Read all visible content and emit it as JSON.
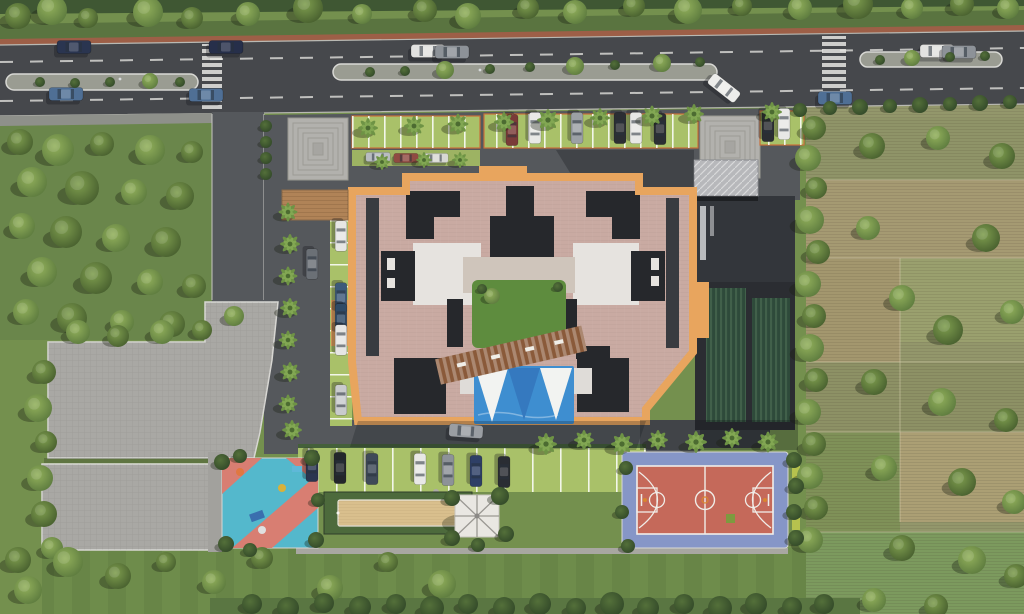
{
  "meta": {
    "title": "Aerial 3D master-plan render of a residential apartment complex",
    "view": "top-down site plan",
    "visible_text": "none"
  },
  "palette": {
    "grass": "#74904e",
    "grassWood": "#6a864b",
    "field": "#93976b",
    "road": "#46484c",
    "asphalt": "#55585c",
    "paver": "#a9a8a4",
    "paverLight": "#b2b1ad",
    "curb": "#cfcfcb",
    "cycle": "#9d5f47",
    "hedge": "#4c6639",
    "roofPink": "#c9aaa2",
    "roofOrange": "#e8a55e",
    "roofDark": "#26282c",
    "roofWhite": "#e6e3df",
    "deck": "#cfc5bb",
    "lawn": "#5e8c3e",
    "pool": "#3e8ed0",
    "sailWhite": "#f2f3f1",
    "sailBlue": "#3579bf",
    "courtOuter": "#8696c7",
    "courtInner": "#c5695a",
    "courtLine": "#f0ede8",
    "pgBlue": "#54b8cc",
    "pgPink": "#d87e72",
    "sand": "#d9bf8d",
    "stall": "#a9c169",
    "wood": "#8a5a3a",
    "woodDeck": "#b08357",
    "gazebo": "#e9e7e2",
    "laneDash": "#d6d6d2",
    "wing": "#2b2d32"
  },
  "site_elements": {
    "main_road": "dual carriageway with planted medians, cycle track, two zebra crossings",
    "building": "courtyard apartment block, terracotta parapet band, dark cores, central garden, pergola and swimming pool with shade sails",
    "amenities": [
      "basketball court",
      "kids playground",
      "sand court",
      "gazebo",
      "pool with tensile sails",
      "lawns"
    ],
    "parking": "perpendicular grass-paver stalls on north, west and south sides plus large paver podium",
    "surroundings": "woodland grove west, farmland plots east, tree-lined boundary hedges"
  },
  "vegetation": {
    "trees": [
      [
        18,
        16,
        13,
        "d"
      ],
      [
        52,
        10,
        15,
        "l"
      ],
      [
        88,
        18,
        10,
        "d"
      ],
      [
        148,
        12,
        15,
        "l"
      ],
      [
        192,
        18,
        11,
        "d"
      ],
      [
        248,
        14,
        12,
        "l"
      ],
      [
        308,
        8,
        15,
        "d"
      ],
      [
        362,
        14,
        10,
        "l"
      ],
      [
        425,
        10,
        12,
        "d"
      ],
      [
        468,
        16,
        13,
        "l"
      ],
      [
        528,
        8,
        11,
        "d"
      ],
      [
        575,
        12,
        12,
        "l"
      ],
      [
        634,
        6,
        11,
        "d"
      ],
      [
        688,
        10,
        14,
        "l"
      ],
      [
        742,
        6,
        10,
        "d"
      ],
      [
        800,
        8,
        12,
        "l"
      ],
      [
        858,
        4,
        15,
        "d"
      ],
      [
        912,
        8,
        11,
        "l"
      ],
      [
        962,
        4,
        12,
        "d"
      ],
      [
        1008,
        8,
        11,
        "l"
      ],
      [
        20,
        142,
        13,
        "d"
      ],
      [
        58,
        150,
        16,
        "l"
      ],
      [
        102,
        144,
        12,
        "d"
      ],
      [
        150,
        150,
        15,
        "l"
      ],
      [
        192,
        152,
        11,
        "d"
      ],
      [
        32,
        182,
        15,
        "l"
      ],
      [
        82,
        188,
        17,
        "d"
      ],
      [
        134,
        192,
        13,
        "l"
      ],
      [
        180,
        196,
        14,
        "d"
      ],
      [
        22,
        226,
        13,
        "l"
      ],
      [
        66,
        232,
        16,
        "d"
      ],
      [
        116,
        238,
        14,
        "l"
      ],
      [
        166,
        242,
        15,
        "d"
      ],
      [
        42,
        272,
        15,
        "l"
      ],
      [
        96,
        278,
        16,
        "d"
      ],
      [
        150,
        282,
        13,
        "l"
      ],
      [
        194,
        286,
        12,
        "d"
      ],
      [
        26,
        312,
        13,
        "l"
      ],
      [
        72,
        318,
        15,
        "d"
      ],
      [
        122,
        322,
        12,
        "l"
      ],
      [
        172,
        324,
        13,
        "d"
      ],
      [
        78,
        332,
        12,
        "l"
      ],
      [
        118,
        336,
        11,
        "d"
      ],
      [
        162,
        332,
        12,
        "l"
      ],
      [
        202,
        330,
        10,
        "d"
      ],
      [
        234,
        316,
        10,
        "l"
      ],
      [
        44,
        372,
        12,
        "d"
      ],
      [
        38,
        408,
        14,
        "l"
      ],
      [
        46,
        442,
        11,
        "d"
      ],
      [
        40,
        478,
        13,
        "l"
      ],
      [
        44,
        514,
        13,
        "d"
      ],
      [
        52,
        548,
        11,
        "l"
      ],
      [
        18,
        560,
        13,
        "d"
      ],
      [
        68,
        562,
        15,
        "l"
      ],
      [
        118,
        576,
        13,
        "d"
      ],
      [
        28,
        590,
        14,
        "l"
      ],
      [
        166,
        562,
        10,
        "d"
      ],
      [
        214,
        582,
        12,
        "l"
      ],
      [
        262,
        558,
        11,
        "d"
      ],
      [
        330,
        588,
        13,
        "l"
      ],
      [
        388,
        562,
        10,
        "d"
      ],
      [
        442,
        584,
        14,
        "l"
      ],
      [
        814,
        128,
        12,
        "d"
      ],
      [
        808,
        158,
        13,
        "l"
      ],
      [
        816,
        188,
        11,
        "d"
      ],
      [
        810,
        220,
        14,
        "l"
      ],
      [
        818,
        252,
        12,
        "d"
      ],
      [
        808,
        284,
        13,
        "l"
      ],
      [
        814,
        316,
        12,
        "d"
      ],
      [
        810,
        348,
        14,
        "l"
      ],
      [
        816,
        380,
        12,
        "d"
      ],
      [
        808,
        412,
        13,
        "l"
      ],
      [
        814,
        444,
        12,
        "d"
      ],
      [
        810,
        476,
        13,
        "l"
      ],
      [
        816,
        508,
        12,
        "d"
      ],
      [
        810,
        540,
        13,
        "l"
      ],
      [
        872,
        146,
        13,
        "d"
      ],
      [
        938,
        138,
        12,
        "l"
      ],
      [
        1002,
        156,
        13,
        "d"
      ],
      [
        868,
        228,
        12,
        "l"
      ],
      [
        986,
        238,
        14,
        "d"
      ],
      [
        902,
        298,
        13,
        "l"
      ],
      [
        948,
        330,
        15,
        "d"
      ],
      [
        1012,
        312,
        12,
        "l"
      ],
      [
        874,
        382,
        13,
        "d"
      ],
      [
        942,
        402,
        14,
        "l"
      ],
      [
        1006,
        420,
        12,
        "d"
      ],
      [
        884,
        468,
        13,
        "l"
      ],
      [
        962,
        482,
        14,
        "d"
      ],
      [
        1014,
        502,
        12,
        "l"
      ],
      [
        902,
        548,
        13,
        "d"
      ],
      [
        972,
        560,
        14,
        "l"
      ],
      [
        1016,
        576,
        12,
        "d"
      ],
      [
        874,
        600,
        12,
        "l"
      ],
      [
        936,
        606,
        12,
        "d"
      ],
      [
        492,
        296,
        8,
        "l"
      ],
      [
        482,
        289,
        5,
        "b"
      ],
      [
        558,
        287,
        5,
        "b"
      ],
      [
        40,
        82,
        5,
        "b"
      ],
      [
        75,
        83,
        5,
        "b"
      ],
      [
        110,
        82,
        5,
        "b"
      ],
      [
        150,
        81,
        8,
        "l"
      ],
      [
        180,
        82,
        5,
        "b"
      ],
      [
        370,
        72,
        5,
        "b"
      ],
      [
        405,
        71,
        5,
        "b"
      ],
      [
        445,
        70,
        9,
        "l"
      ],
      [
        490,
        69,
        5,
        "b"
      ],
      [
        530,
        67,
        5,
        "b"
      ],
      [
        575,
        66,
        9,
        "l"
      ],
      [
        615,
        65,
        5,
        "b"
      ],
      [
        662,
        63,
        9,
        "l"
      ],
      [
        700,
        62,
        5,
        "b"
      ],
      [
        880,
        60,
        5,
        "b"
      ],
      [
        912,
        58,
        8,
        "l"
      ],
      [
        950,
        57,
        5,
        "b"
      ],
      [
        985,
        56,
        5,
        "b"
      ],
      [
        222,
        462,
        8,
        "b"
      ],
      [
        240,
        456,
        7,
        "b"
      ],
      [
        312,
        458,
        8,
        "b"
      ],
      [
        318,
        500,
        7,
        "b"
      ],
      [
        316,
        540,
        8,
        "b"
      ],
      [
        226,
        544,
        8,
        "b"
      ],
      [
        250,
        550,
        7,
        "b"
      ],
      [
        452,
        498,
        8,
        "b"
      ],
      [
        500,
        496,
        9,
        "b"
      ],
      [
        506,
        534,
        8,
        "b"
      ],
      [
        452,
        538,
        8,
        "b"
      ],
      [
        478,
        545,
        7,
        "b"
      ],
      [
        626,
        468,
        7,
        "b"
      ],
      [
        622,
        512,
        7,
        "b"
      ],
      [
        628,
        546,
        7,
        "b"
      ],
      [
        252,
        604,
        10,
        "b"
      ],
      [
        288,
        608,
        11,
        "b"
      ],
      [
        324,
        603,
        10,
        "b"
      ],
      [
        360,
        607,
        11,
        "b"
      ],
      [
        396,
        604,
        10,
        "b"
      ],
      [
        432,
        608,
        12,
        "b"
      ],
      [
        468,
        604,
        10,
        "b"
      ],
      [
        504,
        608,
        11,
        "b"
      ],
      [
        540,
        604,
        11,
        "b"
      ],
      [
        576,
        608,
        10,
        "b"
      ],
      [
        612,
        604,
        12,
        "b"
      ],
      [
        648,
        608,
        11,
        "b"
      ],
      [
        684,
        604,
        10,
        "b"
      ],
      [
        720,
        608,
        12,
        "b"
      ],
      [
        756,
        604,
        11,
        "b"
      ],
      [
        792,
        607,
        10,
        "b"
      ],
      [
        824,
        604,
        10,
        "b"
      ],
      [
        800,
        110,
        7,
        "b"
      ],
      [
        830,
        108,
        7,
        "b"
      ],
      [
        860,
        107,
        8,
        "b"
      ],
      [
        890,
        106,
        7,
        "b"
      ],
      [
        920,
        105,
        8,
        "b"
      ],
      [
        950,
        104,
        7,
        "b"
      ],
      [
        980,
        103,
        8,
        "b"
      ],
      [
        1010,
        102,
        7,
        "b"
      ],
      [
        794,
        460,
        8,
        "b"
      ],
      [
        796,
        486,
        8,
        "b"
      ],
      [
        794,
        512,
        8,
        "b"
      ],
      [
        796,
        538,
        8,
        "b"
      ],
      [
        266,
        126,
        6,
        "b"
      ],
      [
        266,
        142,
        6,
        "b"
      ],
      [
        266,
        158,
        6,
        "b"
      ],
      [
        266,
        174,
        6,
        "b"
      ]
    ],
    "palms": [
      [
        368,
        128,
        1
      ],
      [
        414,
        126,
        1
      ],
      [
        458,
        124,
        1.05
      ],
      [
        504,
        122,
        1
      ],
      [
        548,
        120,
        1.1
      ],
      [
        600,
        118,
        1
      ],
      [
        652,
        116,
        1.05
      ],
      [
        694,
        114,
        1
      ],
      [
        772,
        112,
        1
      ],
      [
        382,
        162,
        0.8
      ],
      [
        424,
        160,
        0.8
      ],
      [
        460,
        160,
        0.8
      ],
      [
        288,
        212,
        0.95
      ],
      [
        290,
        244,
        1
      ],
      [
        288,
        276,
        0.95
      ],
      [
        290,
        308,
        1
      ],
      [
        288,
        340,
        0.95
      ],
      [
        290,
        372,
        1
      ],
      [
        288,
        404,
        0.95
      ],
      [
        292,
        430,
        1
      ],
      [
        546,
        444,
        1.1
      ],
      [
        584,
        440,
        1
      ],
      [
        622,
        444,
        1.1
      ],
      [
        658,
        440,
        1
      ],
      [
        696,
        442,
        1.1
      ],
      [
        732,
        438,
        1
      ],
      [
        768,
        442,
        1.05
      ]
    ]
  },
  "vehicles": {
    "cars": [
      [
        74,
        47,
        0,
        1,
        "#2a3550"
      ],
      [
        66,
        94,
        0,
        1,
        "#4f6f95"
      ],
      [
        226,
        47,
        0,
        1,
        "#262f4a"
      ],
      [
        206,
        95,
        0,
        1,
        "#4f6f95"
      ],
      [
        428,
        51,
        0,
        1,
        "#e2e2e0"
      ],
      [
        452,
        52,
        0,
        1,
        "#8d9298"
      ],
      [
        724,
        88,
        38,
        1,
        "#ededeb"
      ],
      [
        835,
        98,
        0,
        1,
        "#4f6f95"
      ],
      [
        937,
        51,
        0,
        1,
        "#e2e2e0"
      ],
      [
        959,
        52,
        0,
        1,
        "#8d9298"
      ],
      [
        512,
        130,
        90,
        0.92,
        "#7a3b38"
      ],
      [
        535,
        128,
        90,
        0.92,
        "#e8e8e6"
      ],
      [
        577,
        128,
        90,
        0.92,
        "#9ba0a5"
      ],
      [
        620,
        128,
        90,
        0.92,
        "#2b2e33"
      ],
      [
        636,
        128,
        90,
        0.92,
        "#e8e8e6"
      ],
      [
        660,
        129,
        90,
        0.92,
        "#2b2e33"
      ],
      [
        768,
        126,
        90,
        0.92,
        "#2b2e33"
      ],
      [
        784,
        124,
        90,
        0.92,
        "#e8e8e6"
      ],
      [
        378,
        157,
        0,
        0.72,
        "#b8bcc0"
      ],
      [
        406,
        158,
        0,
        0.72,
        "#8f4a42"
      ],
      [
        436,
        158,
        0,
        0.72,
        "#d8d8d4"
      ],
      [
        341,
        236,
        90,
        0.9,
        "#e6e6e4"
      ],
      [
        341,
        298,
        90,
        0.9,
        "#3d5a7a"
      ],
      [
        341,
        319,
        90,
        0.9,
        "#2f4a66"
      ],
      [
        341,
        340,
        90,
        0.9,
        "#e6e6e4"
      ],
      [
        341,
        400,
        90,
        0.9,
        "#c9cbcd"
      ],
      [
        312,
        264,
        90,
        0.9,
        "#6b7076"
      ],
      [
        312,
        466,
        90,
        0.92,
        "#2a3550"
      ],
      [
        340,
        468,
        90,
        0.92,
        "#23262b"
      ],
      [
        372,
        469,
        90,
        0.92,
        "#3f4a58"
      ],
      [
        420,
        469,
        90,
        0.92,
        "#e8e8e6"
      ],
      [
        448,
        470,
        90,
        0.92,
        "#8d9298"
      ],
      [
        476,
        471,
        90,
        0.92,
        "#2e3f66"
      ],
      [
        504,
        472,
        90,
        0.92,
        "#2a2d33"
      ],
      [
        466,
        431,
        4,
        1,
        "#9a9ea3"
      ]
    ]
  }
}
